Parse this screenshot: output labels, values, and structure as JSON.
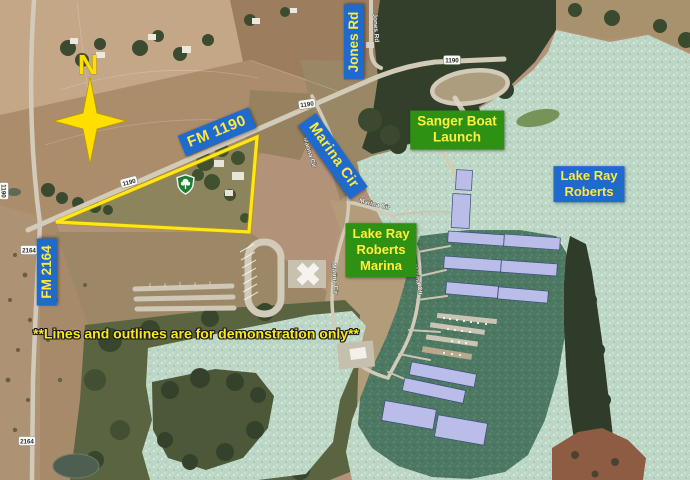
{
  "annotations": {
    "north_indicator": "N",
    "road_labels": {
      "fm1190": "FM 1190",
      "jones_rd": "Jones Rd",
      "marina_cir": "Marina Cir",
      "fm2164": "FM 2164"
    },
    "place_labels": {
      "sanger_boat_launch": {
        "line1": "Sanger Boat",
        "line2": "Launch"
      },
      "lake_ray_roberts": {
        "line1": "Lake Ray",
        "line2": "Roberts"
      },
      "lake_ray_roberts_marina": {
        "line1": "Lake Ray",
        "line2": "Roberts",
        "line3": "Marina"
      }
    },
    "disclaimer": "**Lines and outlines are for demonstration only**"
  },
  "imagery_labels": {
    "route_1190": "1190",
    "route_2164": "2164",
    "jones_rd": "Jones Rd",
    "marina_cir": "Marina Cir"
  },
  "colors": {
    "label_blue_bg": "#1e6bcd",
    "label_green_bg": "#2f9113",
    "label_text_yellow": "#ffe93a",
    "annotation_yellow": "#ffe713",
    "compass_yellow": "#ffdf00",
    "water_open": "#bdd7c6",
    "water_marina_cove": "#4d7862",
    "dock_roof_lavender": "#b9bde8",
    "park_shield_green": "#1e7c33"
  }
}
